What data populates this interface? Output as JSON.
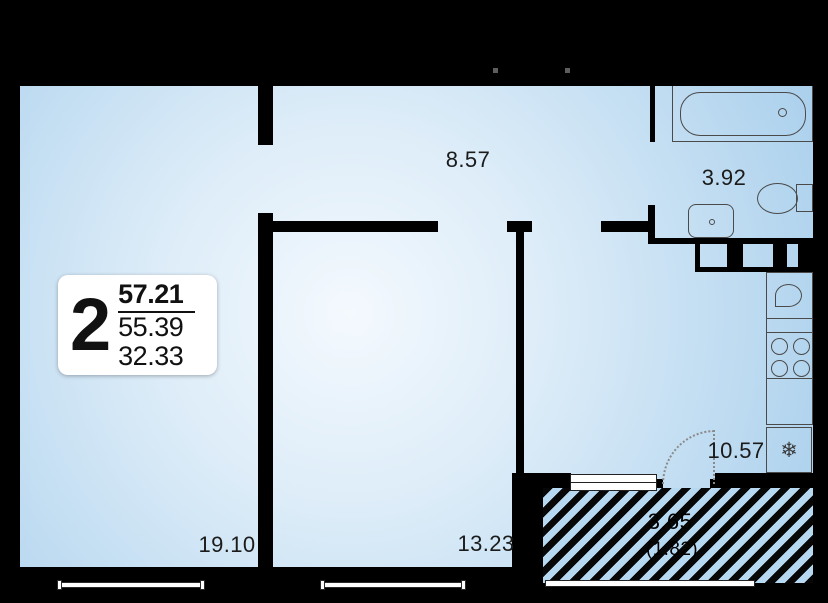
{
  "apartment_card": {
    "rooms_count": "2",
    "total_area": "57.21",
    "area_second": "55.39",
    "area_third": "32.33"
  },
  "room_areas": {
    "hallway": "8.57",
    "bathroom": "3.92",
    "kitchen": "10.57",
    "bedroom": "19.10",
    "room2": "13.23",
    "balcony": "3.65",
    "balcony_reduced": "(1.82)"
  },
  "icons": {
    "fridge_snowflake": "❄"
  },
  "colors": {
    "background": "#000000",
    "walls": "#000000",
    "room_fill_center": "#f4f9fe",
    "room_fill_edge": "#a9cfec",
    "hatch_blue": "#b7d8f1",
    "hatch_stripe": "#070707",
    "card_background": "#ffffff",
    "label_text": "#1b1b1b"
  }
}
